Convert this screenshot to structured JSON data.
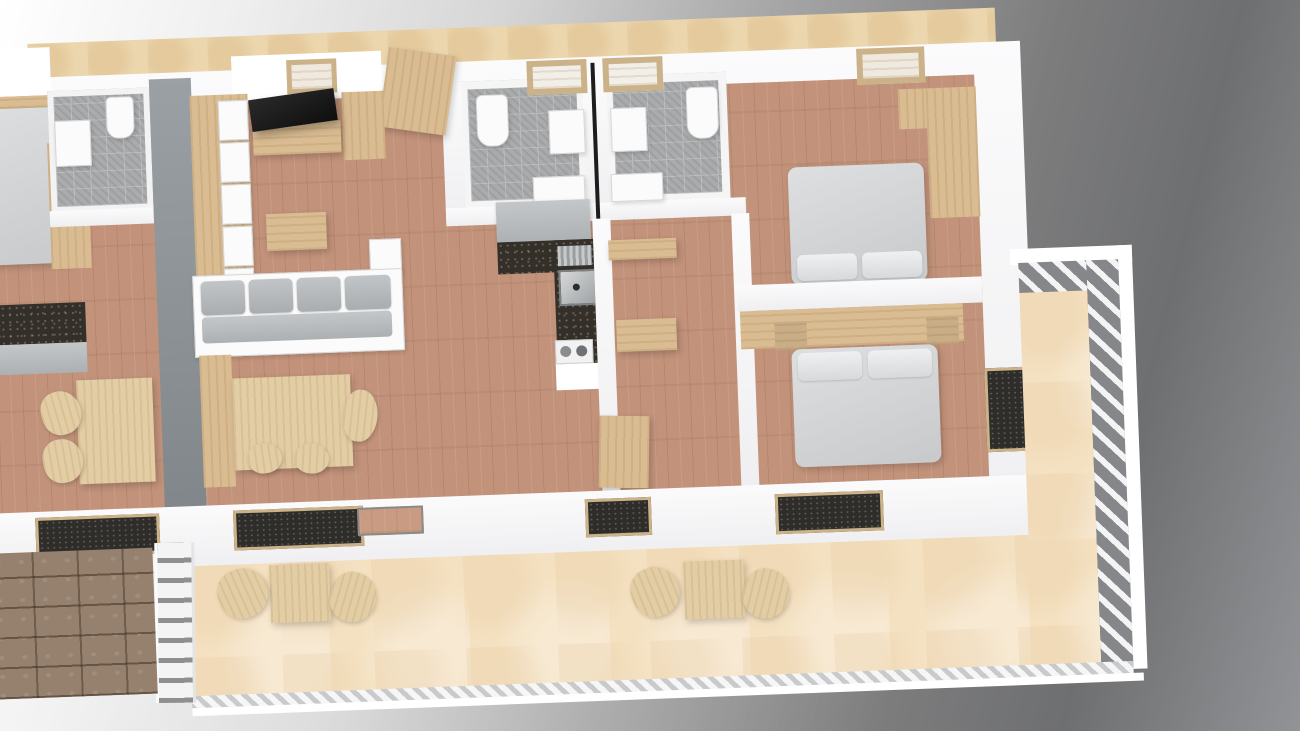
{
  "scene": {
    "kind": "3d-rendered-floor-plan",
    "view": "top-down-perspective",
    "text_visible": false,
    "units_shown": 2,
    "main_unit": {
      "rooms": [
        {
          "name": "living-dining-room",
          "floor": "wood-parquet"
        },
        {
          "name": "kitchen",
          "floor": "wood-parquet"
        },
        {
          "name": "bathroom-left",
          "floor": "gray-pattern-tile"
        },
        {
          "name": "bathroom-right",
          "floor": "gray-pattern-tile"
        },
        {
          "name": "hallway",
          "floor": "wood-parquet"
        },
        {
          "name": "bedroom-top",
          "floor": "wood-parquet"
        },
        {
          "name": "bedroom-bottom",
          "floor": "wood-parquet"
        },
        {
          "name": "terrace",
          "floor": "beige-stone"
        }
      ],
      "furniture": [
        "dresser-with-white-drawers",
        "tv-flatscreen",
        "tv-stand",
        "tall-wardrobe-entry",
        "corner-sofa-gray",
        "coffee-table",
        "dining-table",
        "dining-bench",
        "dining-chairs",
        "kitchen-counter-dark",
        "kitchen-sink",
        "kitchen-cooktop",
        "kitchen-cabinet-gray",
        "toilet-x2",
        "washbasin-x2",
        "shower-tray-x2",
        "double-bed-top",
        "double-bed-bottom",
        "headboard-panel",
        "wardrobe-bedroom",
        "nightstands",
        "terrace-table-x2",
        "terrace-chairs-x4"
      ]
    },
    "neighbor_unit": {
      "rooms": [
        {
          "name": "bedroom"
        },
        {
          "name": "bathroom"
        },
        {
          "name": "living-area"
        }
      ],
      "furniture": [
        "double-bed",
        "wardrobe",
        "vanity",
        "toilet",
        "dining-table",
        "chairs",
        "kitchen-counter"
      ]
    },
    "exterior": [
      "upper-walkway-beige",
      "cobblestone-path",
      "white-fence",
      "terrace-railing-hatched"
    ]
  },
  "palette": {
    "background_light": "#ffffff",
    "background_dark": "#6e6f71",
    "wall_white": "#f7f7f8",
    "wall_gray": "#8e9497",
    "wood_floor": "#c2927a",
    "furniture_wood": "#d9bc92",
    "terrace_beige": "#f4e1c1",
    "walkway_beige": "#ecd6ad",
    "tile_gray": "#a9abad",
    "counter_dark": "#343029",
    "upholstery_gray": "#c4c7c9",
    "bed_gray": "#d6d8da",
    "cobblestone": "#95816e",
    "railing_slat_gray": "#85878a",
    "tv_black": "#151515"
  }
}
